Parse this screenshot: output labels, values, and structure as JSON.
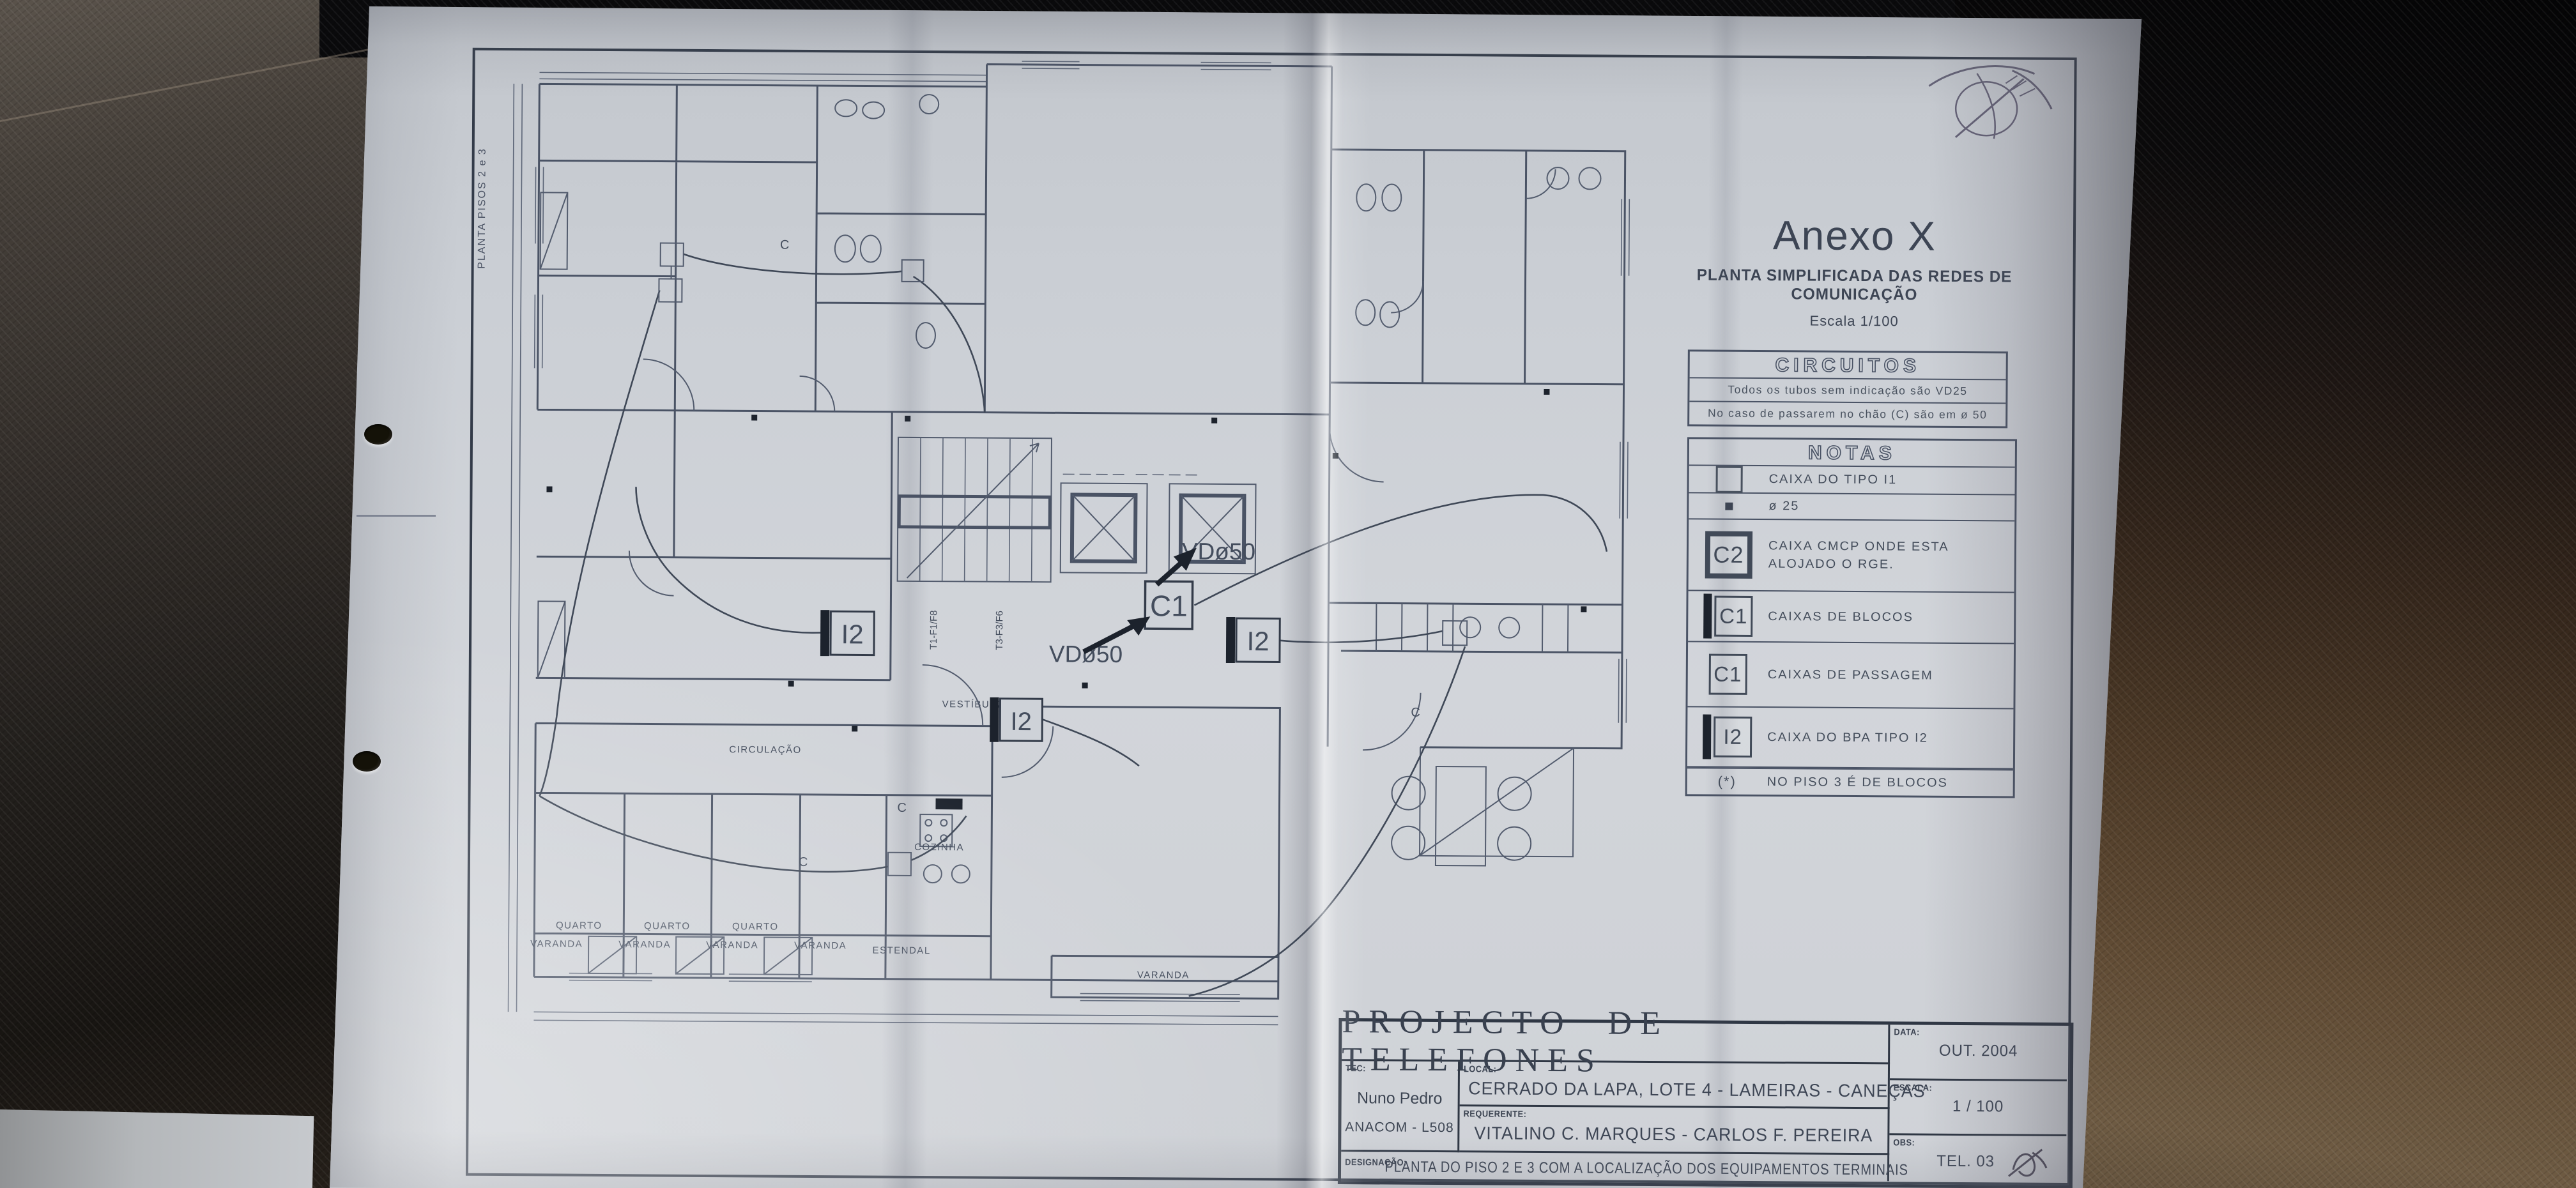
{
  "colors": {
    "ink": "#4a5365",
    "paper": "#ced2d8",
    "leather_dark": "#161310",
    "leather_brown": "#5e4a39"
  },
  "sheet": {
    "side_label": "PLANTA PISOS 2 e 3"
  },
  "anexo": {
    "title": "Anexo X",
    "subtitle": "PLANTA SIMPLIFICADA DAS REDES DE COMUNICAÇÃO",
    "scale": "Escala 1/100"
  },
  "circuitos": {
    "title": "CIRCUITOS",
    "line1": "Todos os tubos sem indicação são VD25",
    "line2": "No caso de passarem no chão (C) são em ø 50"
  },
  "notas": {
    "title": "NOTAS",
    "rows": [
      {
        "symbol": "",
        "label": "CAIXA DO TIPO I1"
      },
      {
        "symbol": "",
        "label": "ø 25"
      },
      {
        "symbol": "C2",
        "label": "CAIXA CMCP ONDE ESTA ALOJADO O RGE."
      },
      {
        "symbol": "C1",
        "label": "CAIXAS DE BLOCOS"
      },
      {
        "symbol": "C1",
        "label": "CAIXAS DE PASSAGEM"
      },
      {
        "symbol": "I2",
        "label": "CAIXA DO BPA TIPO I2"
      },
      {
        "symbol": "(*)",
        "label": "NO PISO 3 É DE BLOCOS"
      }
    ]
  },
  "titleblock": {
    "title": "PROJECTO DE TELEFONES",
    "tec_label": "TEC:",
    "tec_name": "Nuno Pedro",
    "tec_id": "ANACOM - L508",
    "local_label": "LOCAL:",
    "local_value": "CERRADO DA LAPA, LOTE 4 - LAMEIRAS - CANEÇAS",
    "requerente_label": "REQUERENTE:",
    "requerente_value": "VITALINO C. MARQUES - CARLOS F. PEREIRA",
    "designacao_label": "DESIGNAÇÃO:",
    "designacao_value": "PLANTA DO PISO 2 E 3 COM A LOCALIZAÇÃO DOS EQUIPAMENTOS TERMINAIS",
    "data_label": "DATA:",
    "data_value": "OUT. 2004",
    "escala_label": "ESCALA:",
    "escala_value": "1 / 100",
    "obs_label": "OBS:",
    "obs_value": "TEL. 03"
  },
  "plan": {
    "vd50_upper": "VDø50",
    "vd50_lower": "VDø50",
    "c1": "C1",
    "i2_left": "I2",
    "i2_mid": "I2",
    "i2_right": "I2",
    "wire_label": "C",
    "riser_left": "T1-F1/F8",
    "riser_right": "T3-F3/F6",
    "rooms": {
      "circulacao": "CIRCULAÇÃO",
      "vestibulo": "VESTÍBULO",
      "cozinha": "COZINHA",
      "estendal": "ESTENDAL",
      "quarto1": "QUARTO",
      "quarto2": "QUARTO",
      "quarto3": "QUARTO",
      "varanda1": "VARANDA",
      "varanda2": "VARANDA",
      "varanda3": "VARANDA",
      "varanda4": "VARANDA",
      "varanda5": "VARANDA"
    }
  }
}
